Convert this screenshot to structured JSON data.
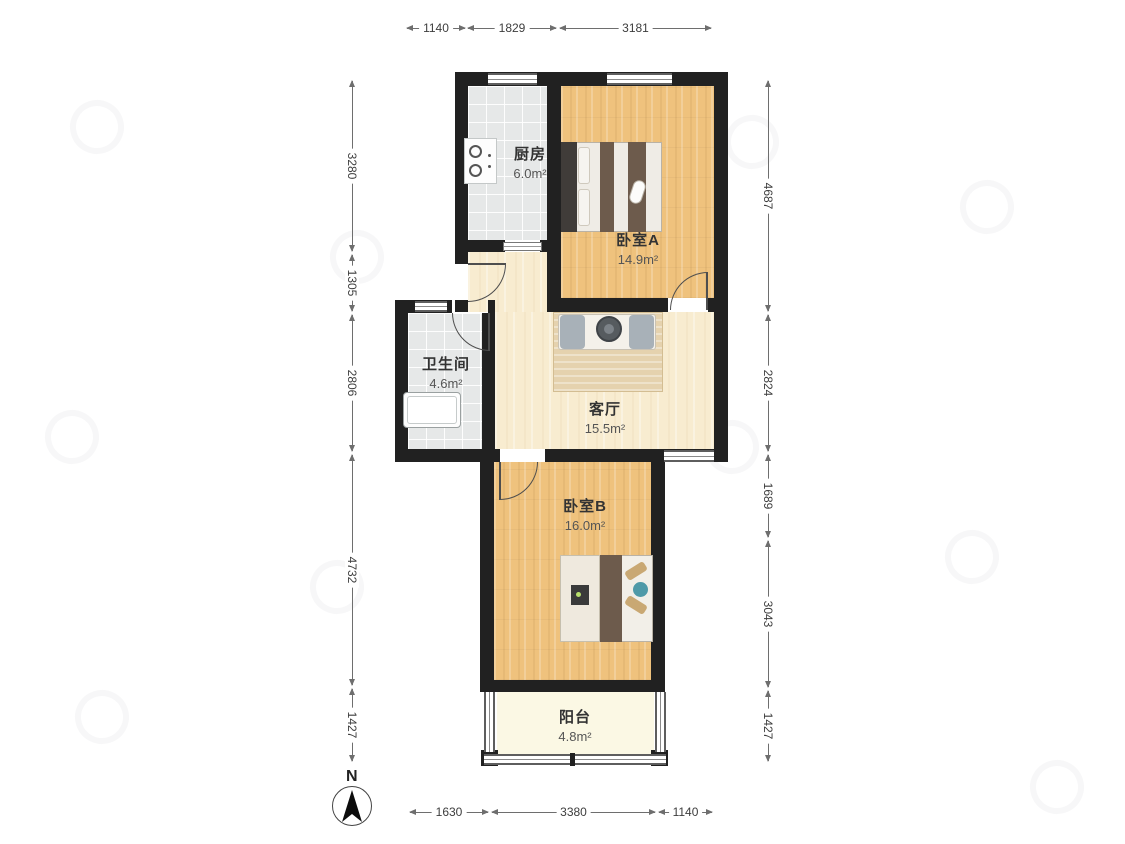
{
  "plan": {
    "north_label": "N",
    "rooms": {
      "kitchen": {
        "name": "厨房",
        "area": "6.0m²"
      },
      "bedroomA": {
        "name": "卧室A",
        "area": "14.9m²"
      },
      "bathroom": {
        "name": "卫生间",
        "area": "4.6m²"
      },
      "living": {
        "name": "客厅",
        "area": "15.5m²"
      },
      "bedroomB": {
        "name": "卧室B",
        "area": "16.0m²"
      },
      "balcony": {
        "name": "阳台",
        "area": "4.8m²"
      }
    }
  },
  "dims": {
    "top": [
      "1140",
      "1829",
      "3181"
    ],
    "bottom": [
      "1630",
      "3380",
      "1140"
    ],
    "left": [
      "3280",
      "1305",
      "2806",
      "4732",
      "1427"
    ],
    "right": [
      "4687",
      "2824",
      "1689",
      "3043",
      "1427"
    ]
  },
  "colors": {
    "wall": "#212121",
    "wood_floor": "#efc27d",
    "living_floor": "#f8ecd0",
    "tile_floor": "#e6e8e8",
    "balcony_floor": "#fbf8e4",
    "dimension_line": "#6e6e6e"
  }
}
